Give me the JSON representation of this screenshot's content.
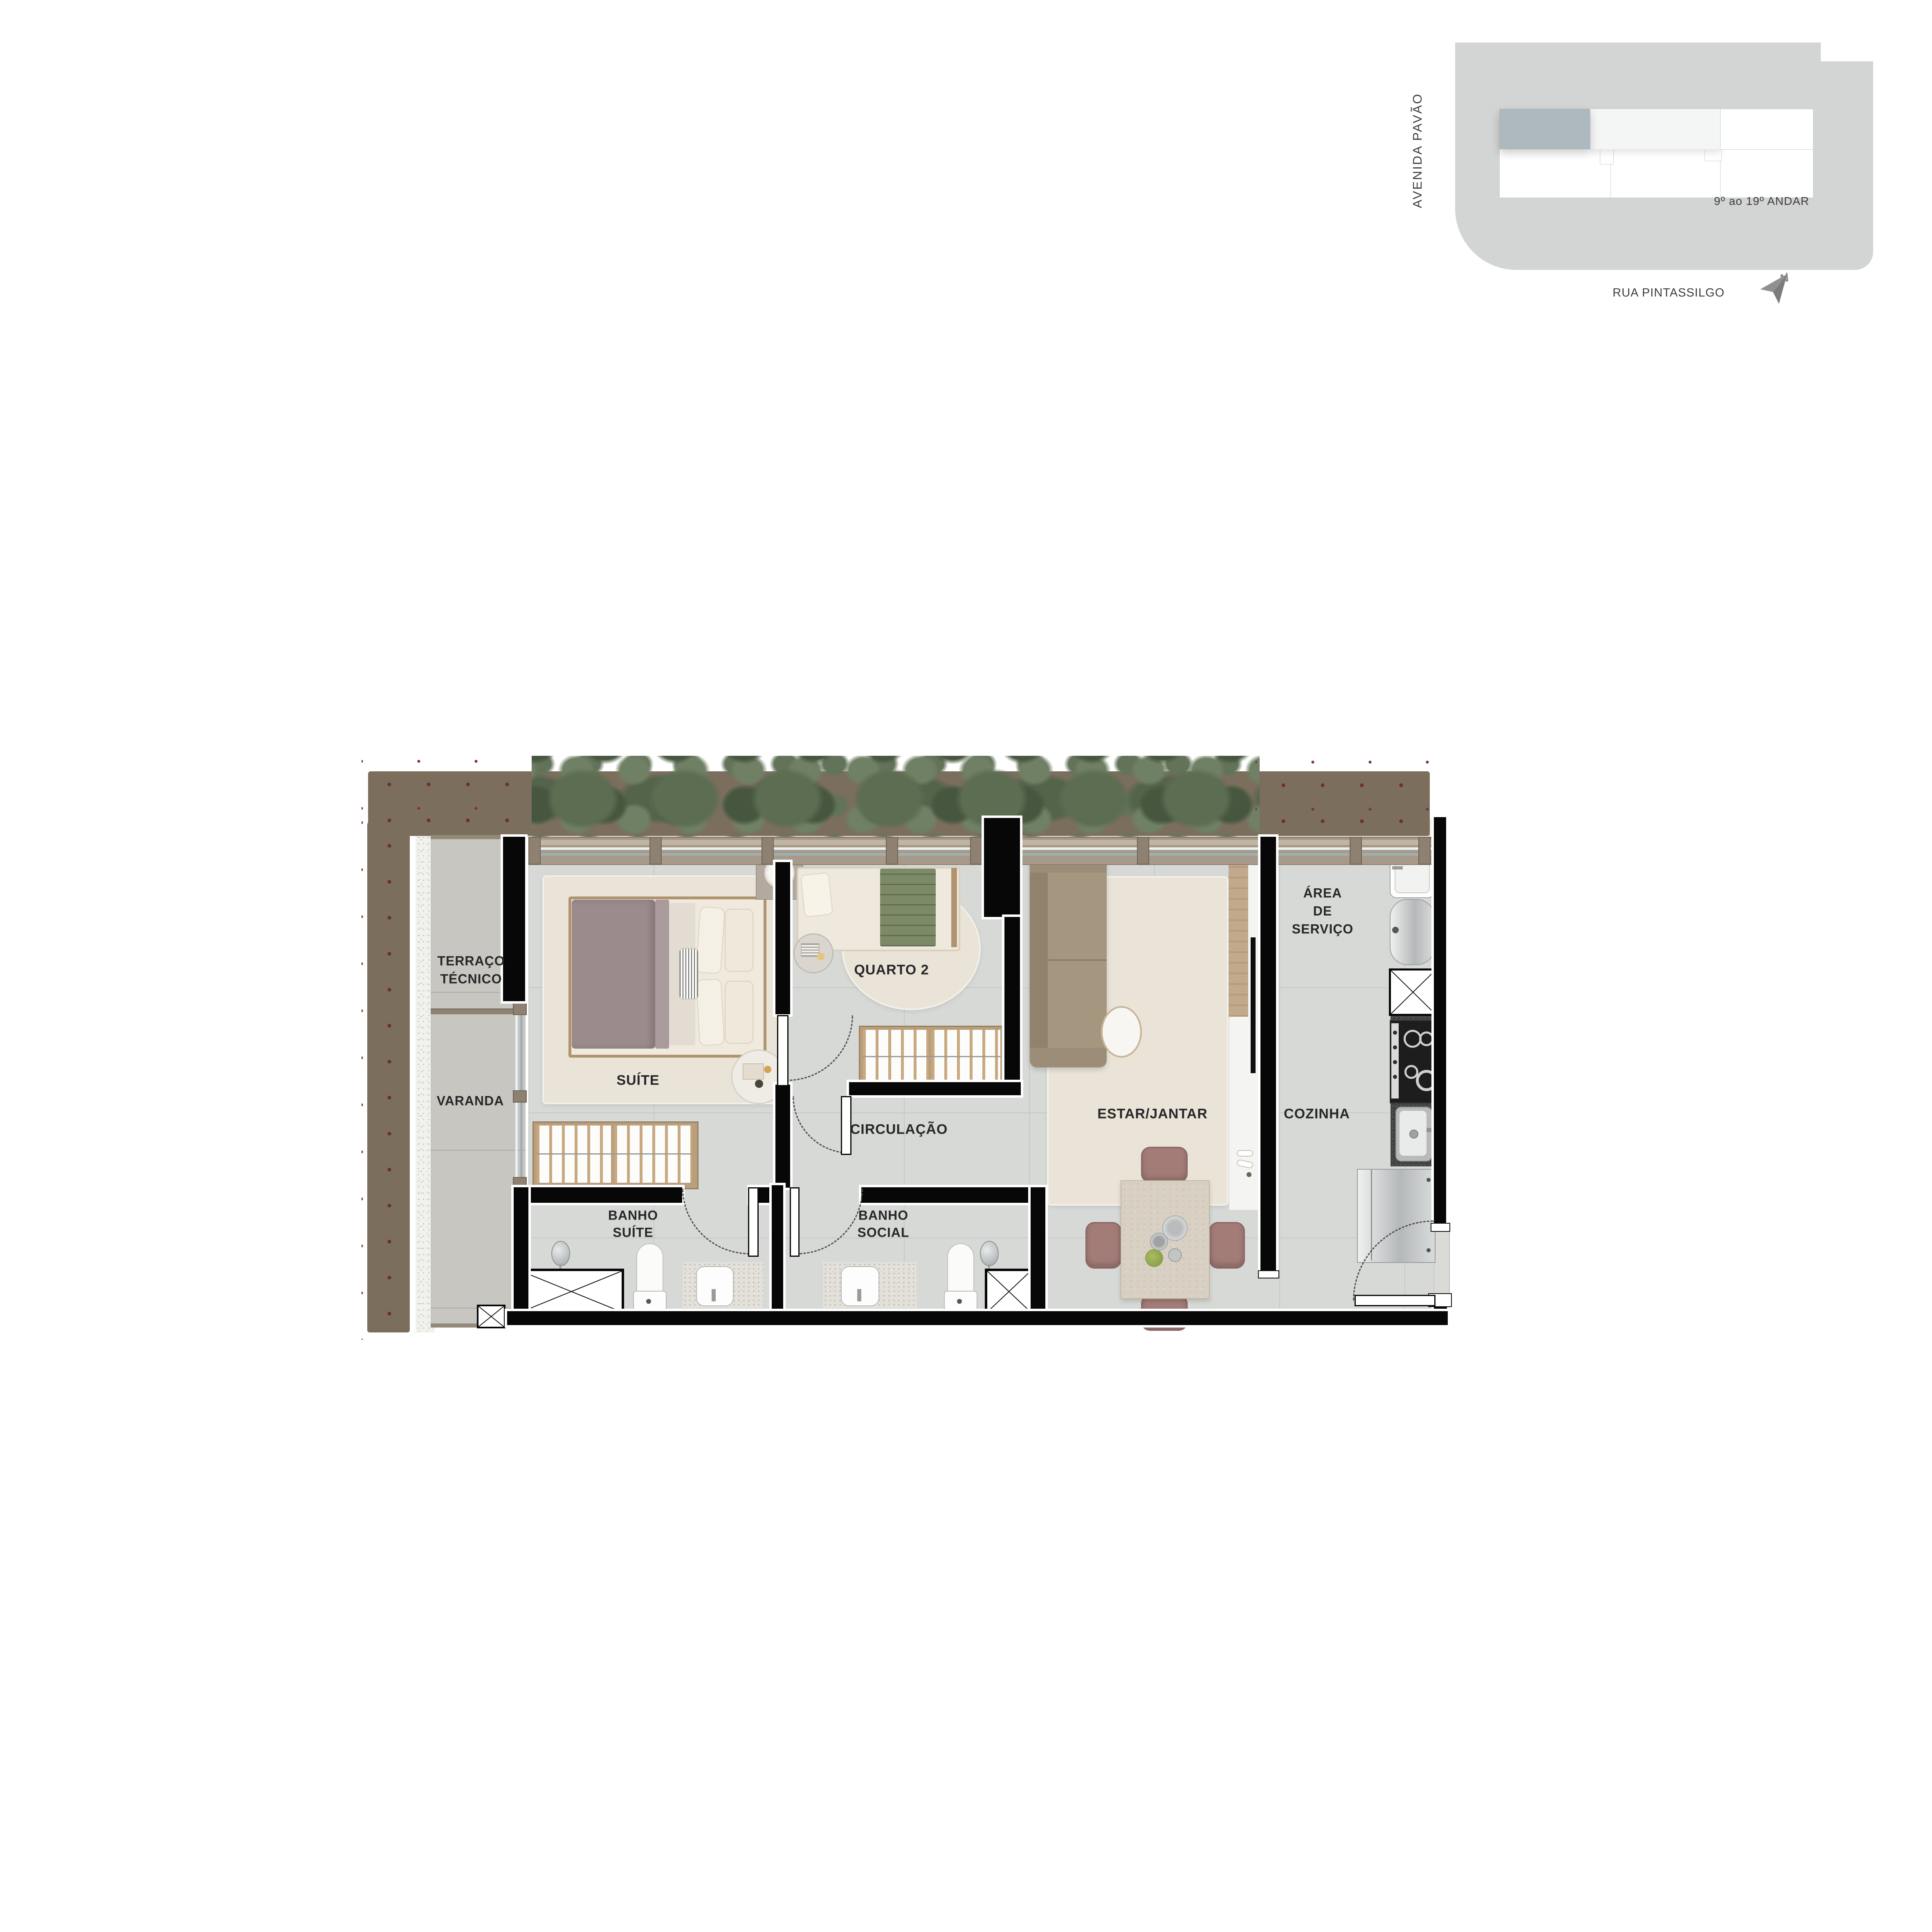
{
  "keyplan": {
    "street_left": "AVENIDA PAVÃO",
    "street_bottom": "RUA PINTASSILGO",
    "floor_range": "9º ao 19º ANDAR",
    "north_label": "N",
    "icons": {
      "north_arrow": "paper-plane-north-arrow"
    },
    "colors": {
      "site_block": "#d3d4d4",
      "unit_highlight": "#aeb9bf",
      "unit_light": "#f4f5f5",
      "unit_white": "#ffffff"
    }
  },
  "rooms": {
    "terraco_line1": "TERRAÇO",
    "terraco_line2": "TÉCNICO",
    "varanda": "VARANDA",
    "suite": "SUÍTE",
    "quarto2": "QUARTO 2",
    "circulacao": "CIRCULAÇÃO",
    "banho_suite_line1": "BANHO",
    "banho_suite_line2": "SUÍTE",
    "banho_social_line1": "BANHO",
    "banho_social_line2": "SOCIAL",
    "estar": "ESTAR/JANTAR",
    "cozinha": "COZINHA",
    "area_line1": "ÁREA",
    "area_line2": "DE",
    "area_line3": "SERVIÇO"
  },
  "palette": {
    "wall": "#070707",
    "interior_floor": "#d6d9d6",
    "outdoor_slab": "#c7c6c1",
    "window_frame": "#a79a8a",
    "hedge_green": "#5c6d52",
    "rug_cream": "#e9e3d8",
    "sofa_taupe": "#a5977f",
    "bed_blanket_mauve": "#9c8b8c",
    "dining_chair_mauve": "#a37c78",
    "granite_dark": "#454545"
  }
}
